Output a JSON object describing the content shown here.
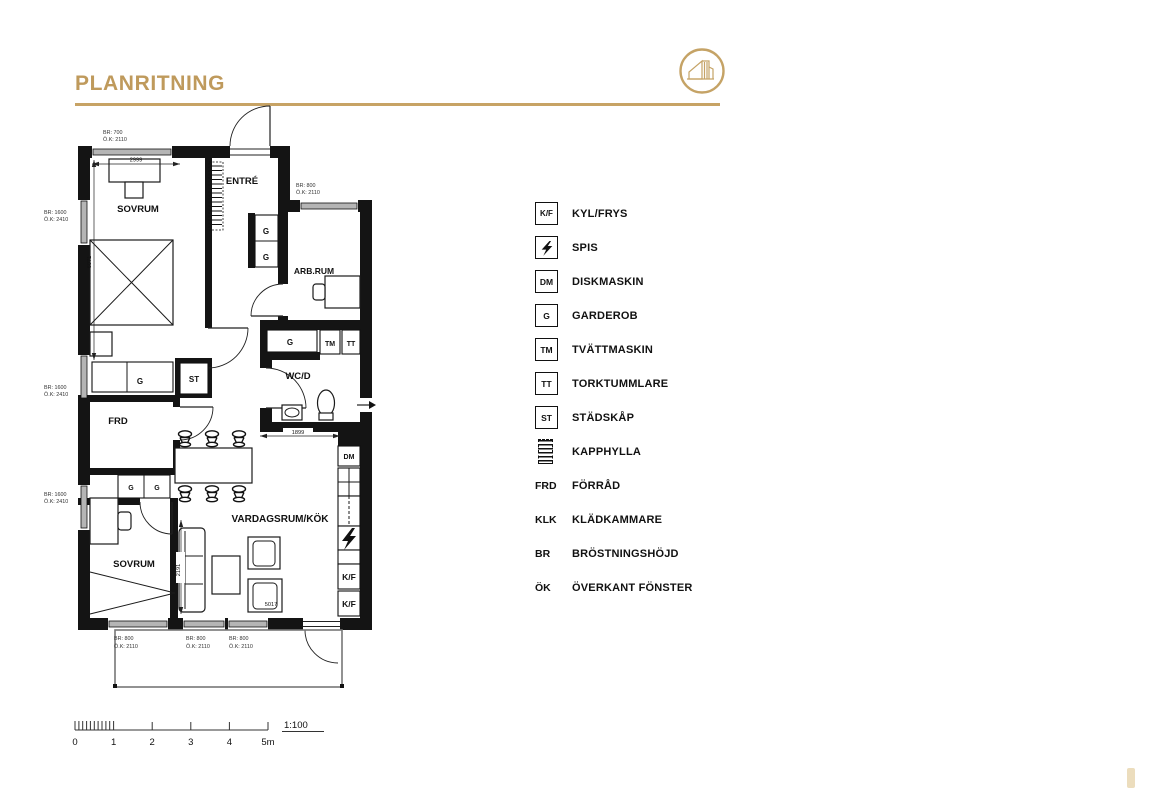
{
  "header": {
    "title": "PLANRITNING"
  },
  "plan": {
    "rooms": {
      "sovrum_1": "SOVRUM",
      "entre": "ENTRÉ",
      "arbrum": "ARB.RUM",
      "wcd": "WC/D",
      "frd": "FRD",
      "sovrum_2": "SOVRUM",
      "vardagsrum": "VARDAGSRUM/KÖK"
    },
    "labels": {
      "g": "G",
      "st": "ST",
      "tm": "TM",
      "tt": "TT",
      "dm": "DM",
      "kf": "K/F"
    },
    "dims": {
      "d2999": "2999",
      "d6071": "6071",
      "d1899": "1899",
      "d2191": "2191",
      "d5017": "5017"
    },
    "annotations": {
      "top_window": {
        "br": "BR: 700",
        "ok": "Ö.K: 2110"
      },
      "arbrum_window": {
        "br": "BR: 800",
        "ok": "Ö.K: 2110"
      },
      "left_window": {
        "br": "BR: 1600",
        "ok": "Ö.K: 2410"
      },
      "bottom_window": {
        "br": "BR: 800",
        "ok": "Ö.K: 2110"
      }
    }
  },
  "legend": {
    "items": [
      {
        "symbol": "K/F",
        "label": "KYL/FRYS"
      },
      {
        "symbol": "",
        "label": "SPIS"
      },
      {
        "symbol": "DM",
        "label": "DISKMASKIN"
      },
      {
        "symbol": "G",
        "label": "GARDEROB"
      },
      {
        "symbol": "TM",
        "label": "TVÄTTMASKIN"
      },
      {
        "symbol": "TT",
        "label": "TORKTUMMLARE"
      },
      {
        "symbol": "ST",
        "label": "STÄDSKÅP"
      },
      {
        "symbol": "",
        "label": "KAPPHYLLA"
      },
      {
        "symbol": "FRD",
        "label": "FÖRRÅD"
      },
      {
        "symbol": "KLK",
        "label": "KLÄDKAMMARE"
      },
      {
        "symbol": "BR",
        "label": "BRÖSTNINGSHÖJD"
      },
      {
        "symbol": "ÖK",
        "label": "ÖVERKANT FÖNSTER"
      }
    ]
  },
  "scale": {
    "ticks": [
      "0",
      "1",
      "2",
      "3",
      "4",
      "5m"
    ],
    "ratio": "1:100"
  }
}
